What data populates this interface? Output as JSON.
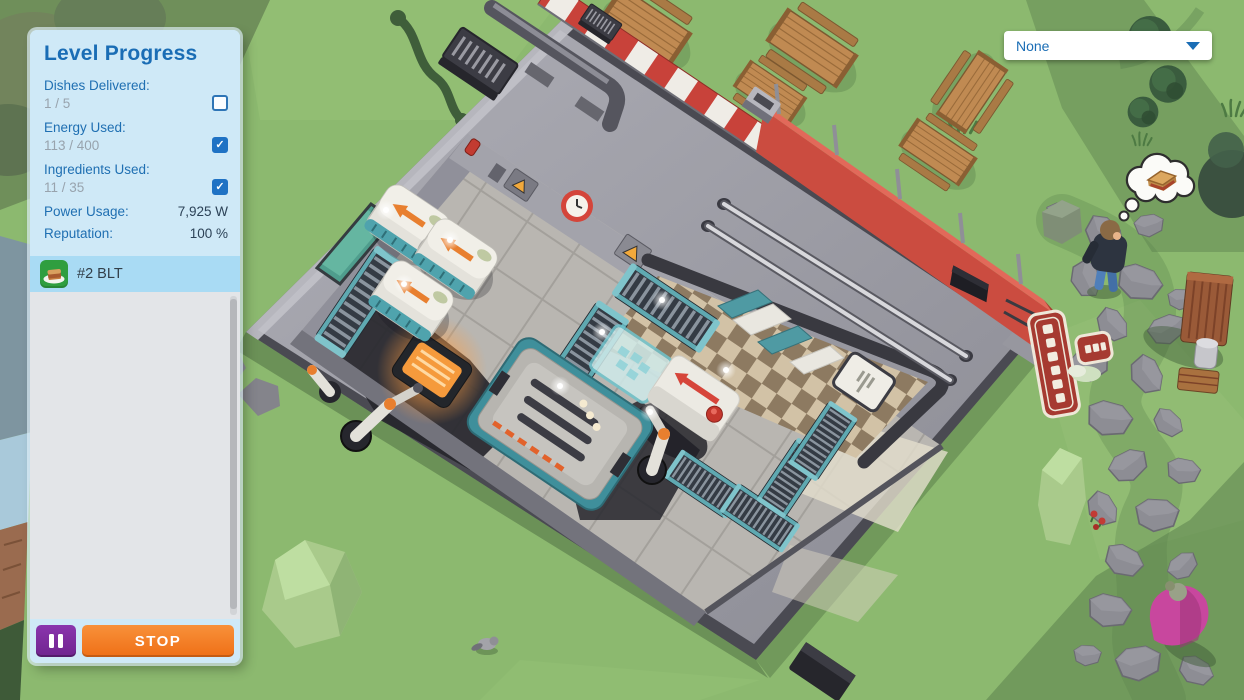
{
  "panel": {
    "title": "Level Progress",
    "goals": [
      {
        "label": "Dishes Delivered:",
        "value": "1 / 5",
        "checked": false
      },
      {
        "label": "Energy Used:",
        "value": "113 / 400",
        "checked": true
      },
      {
        "label": "Ingredients Used:",
        "value": "11 / 35",
        "checked": true
      }
    ],
    "metrics": [
      {
        "label": "Power Usage:",
        "value": "7,925 W"
      },
      {
        "label": "Reputation:",
        "value": "100 %"
      }
    ],
    "orders": [
      {
        "label": "#2 BLT",
        "icon": "blt-dish-icon",
        "selected": true
      }
    ],
    "pause_icon": "pause-icon",
    "stop_label": "STOP"
  },
  "toolbar": {
    "selection_value": "None",
    "caret_icon": "chevron-down-icon"
  },
  "scene": {
    "description": "isometric diner with automated kitchen cutaway",
    "entities": [
      "restaurant-building",
      "red-white-awning",
      "red-fence-wall",
      "roof-vents",
      "grab-rails",
      "ingredient-dispensers",
      "conveyor-belts",
      "grill",
      "oven-machine",
      "assembler-machine",
      "dispatcher-machine",
      "robotic-arms",
      "checkered-dining-floor",
      "booth-seats",
      "serving-hatch-fork-sign",
      "restaurant-signs",
      "picnic-tables",
      "park-bench",
      "stone-path",
      "customer-thinking-of-sandwich",
      "customer-pink-dress",
      "raccoon",
      "rocks",
      "pine-trees"
    ]
  },
  "colors": {
    "accent_blue": "#1a6db5",
    "stop_orange": "#ef6f16",
    "pause_purple": "#7b2d9e",
    "selected_row_blue": "#a9dbf4",
    "panel_blue": "#cfe9f7",
    "grass_green": "#8cb96f",
    "awning_red": "#c8423a",
    "conveyor_teal": "#4f9aa3"
  }
}
